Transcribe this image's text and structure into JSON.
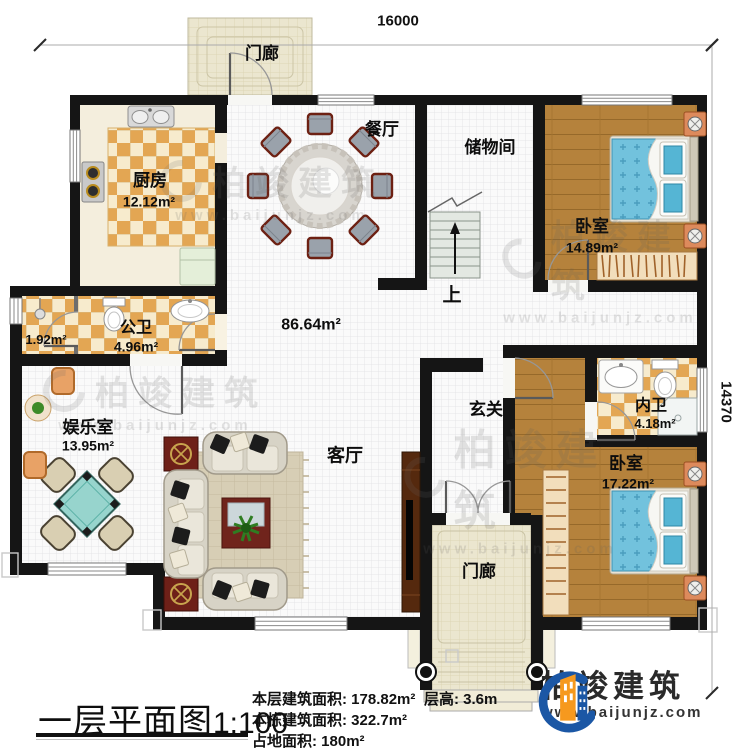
{
  "dimensions": {
    "width": "16000",
    "height": "14370"
  },
  "rooms": {
    "porch_top": {
      "name": "门廊"
    },
    "kitchen": {
      "name": "厨房",
      "area": "12.12m²"
    },
    "dining": {
      "name": "餐厅"
    },
    "storage": {
      "name": "储物间"
    },
    "bedroom_top": {
      "name": "卧室",
      "area": "14.89m²"
    },
    "shower_room": {
      "area": "1.92m²"
    },
    "public_bath": {
      "name": "公卫",
      "area": "4.96m²"
    },
    "hall": {
      "area": "86.64m²"
    },
    "stairs": {
      "up_label": "上"
    },
    "entry": {
      "name": "玄关"
    },
    "ensuite_bath": {
      "name": "内卫",
      "area": "4.18m²"
    },
    "bedroom_bottom": {
      "name": "卧室",
      "area": "17.22m²"
    },
    "game_room": {
      "name": "娱乐室",
      "area": "13.95m²"
    },
    "living": {
      "name": "客厅"
    },
    "porch_bottom": {
      "name": "门廊"
    }
  },
  "watermark": {
    "brand": "柏竣建筑",
    "url": "www.baijunjz.com"
  },
  "title_block": {
    "title": "一层平面图",
    "scale": "1:100",
    "floor_area_label": "本层建筑面积:",
    "floor_area_value": "178.82m²",
    "building_area_label": "本栋建筑面积:",
    "building_area_value": "322.7m²",
    "land_area_label": "占地面积:",
    "land_area_value": "180m²",
    "floor_height_label": "层高:",
    "floor_height_value": "3.6m"
  },
  "logo": {
    "brand": "柏竣建筑",
    "url": "www.baijunjz.com"
  }
}
